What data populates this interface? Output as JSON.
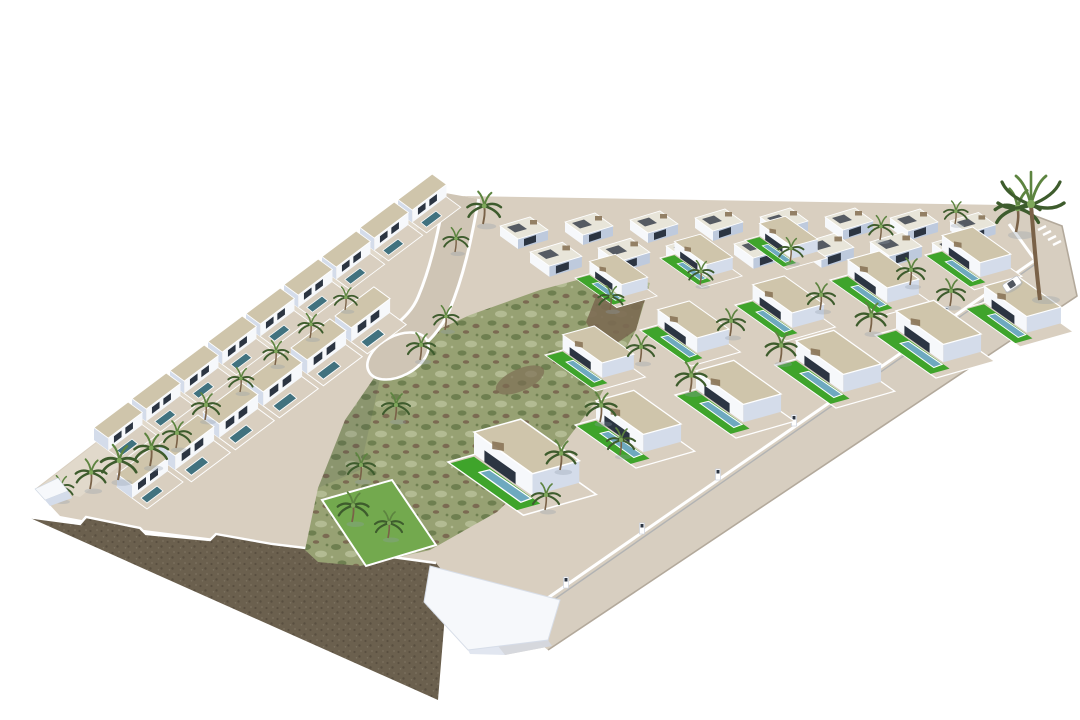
{
  "meta": {
    "type": "3d-architectural-render",
    "description": "Aerial 3D render of a triangular hillside residential development on a white background: two stepped rows of terraced white villas with private pools on the left, a grid of detached white villas with lawns and blue pools on the right, a central undeveloped green scrub field, an entry road ending in a cul-de-sac, a perimeter road with a white car and a zebra crossing on the right, palm trees throughout, and a dark stone retaining wall cutting the hillside at the bottom-left.",
    "background": "#ffffff"
  },
  "palette": {
    "bg": "#ffffff",
    "sand": "#d9cfc0",
    "sandLight": "#e2d9cb",
    "road": "#cfc5b5",
    "roadOuter": "#d7cec0",
    "roadEdge": "#b3a99b",
    "curb": "#ffffff",
    "rock1": "#6b604e",
    "rock2": "#594f40",
    "rock3": "#7d7260",
    "scrub1": "#97a173",
    "scrub2": "#6e7f50",
    "scrub3": "#b3bb93",
    "scrubBrown": "#7b6a52",
    "lawn": "#3fa42b",
    "lawn2": "#73a94e",
    "poolDark": "#41727f",
    "poolLight": "#6ea9bf",
    "wallLit": "#f6f8fb",
    "wallShade": "#d4dcea",
    "wallShade2": "#becadd",
    "opening": "#2c3542",
    "roofGravel": "#cfc5ab",
    "roofLight": "#e8e5d9",
    "roofDark": "#3c434e",
    "pergola": "#8a7458",
    "trunk": "#7a6248",
    "palmDark": "#3e5c2d",
    "palmMid": "#5d8440",
    "palmLight": "#7fa85b",
    "shadow": "#8f9aa8",
    "carBody": "#ffffff",
    "carGlass": "#333a44"
  },
  "scene": {
    "site_shape": "triangular wedge plot seen from above at an angle",
    "left_terraced_rows": {
      "rows": 2,
      "approx_units": 15,
      "features": [
        "beige gravel roofs",
        "dark teal private pools",
        "white walls",
        "palm trees"
      ]
    },
    "right_villa_grid": {
      "rows": 4,
      "approx_units": 29,
      "features": [
        "beige gravel roofs",
        "bright green lawns",
        "blue pools",
        "white garden walls",
        "rooftop pergolas"
      ]
    },
    "central_scrub_field": "undeveloped green/brown scrubland band in the middle of the plot",
    "walled_lawn_garden": "bright lawn enclosure near the bottom tip",
    "entry_road": "road entering from the top edge, ending in a cul-de-sac turning circle",
    "perimeter_road": "beige road wrapping the right and bottom-right boundary wall",
    "boundary_wall": "white wall with gate pillars along the perimeter road",
    "crosswalk": "white zebra stripes at the top-right road corner",
    "car": {
      "color": "white",
      "location": "perimeter road, right side"
    },
    "palm_trees": {
      "approx_count": 40,
      "landmark": "tall double palm at top-right corner"
    },
    "rock_retaining_wall": "dark brown textured stone cut along the bottom-left hypotenuse"
  }
}
